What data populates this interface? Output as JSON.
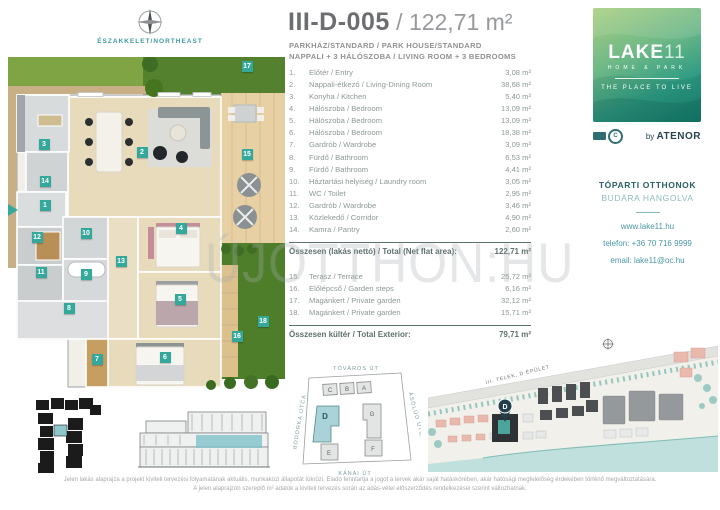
{
  "header": {
    "code": "III-D-005",
    "separator": " / ",
    "area": "122,71 m²",
    "subtitle1": "PARKHÁZ/STANDARD / PARK HOUSE/STANDARD",
    "subtitle2": "NAPPALI + 3 HÁLÓSZOBA  / LIVING ROOM + 3 BEDROOMS"
  },
  "compass": {
    "label": "ÉSZAKKELET/NORTHEAST"
  },
  "rooms": [
    {
      "no": "1.",
      "name": "Előtér / Entry",
      "area": "3,08 m²"
    },
    {
      "no": "2.",
      "name": "Nappali-étkező / Living-Dining Room",
      "area": "38,68 m²"
    },
    {
      "no": "3.",
      "name": "Konyha / Kitchen",
      "area": "5,40 m²"
    },
    {
      "no": "4.",
      "name": "Hálószoba / Bedroom",
      "area": "13,09 m²"
    },
    {
      "no": "5.",
      "name": "Hálószoba / Bedroom",
      "area": "13,09 m²"
    },
    {
      "no": "6.",
      "name": "Hálószoba / Bedroom",
      "area": "18,38 m²"
    },
    {
      "no": "7.",
      "name": "Gardrób / Wardrobe",
      "area": "3,09 m²"
    },
    {
      "no": "8.",
      "name": "Fürdő / Bathroom",
      "area": "6,53 m²"
    },
    {
      "no": "9.",
      "name": "Fürdő / Bathroom",
      "area": "4,41 m²"
    },
    {
      "no": "10.",
      "name": "Háztartási helyiség / Laundry room",
      "area": "3,05 m²"
    },
    {
      "no": "11.",
      "name": "WC / Toilet",
      "area": "2,95 m²"
    },
    {
      "no": "12.",
      "name": "Gardrób / Wardrobe",
      "area": "3,46 m²"
    },
    {
      "no": "13.",
      "name": "Közlekedő / Corridor",
      "area": "4,90 m²"
    },
    {
      "no": "14.",
      "name": "Kamra / Pantry",
      "area": "2,60 m²"
    }
  ],
  "net_total": {
    "label": "Összesen (lakás nettó) / Total (Net flat area):",
    "value": "122,71 m²"
  },
  "exterior_rooms": [
    {
      "no": "15.",
      "name": "Terasz / Terrace",
      "area": "25,72 m²"
    },
    {
      "no": "16.",
      "name": "Előlépcső / Garden steps",
      "area": "6,16 m²"
    },
    {
      "no": "17.",
      "name": "Magánkert / Private garden",
      "area": "32,12 m²"
    },
    {
      "no": "18.",
      "name": "Magánkert / Private garden",
      "area": "15,71 m²"
    }
  ],
  "exterior_total": {
    "label": "Összesen kültér / Total Exterior:",
    "value": "79,71 m²"
  },
  "plan_badges": [
    {
      "label": "1",
      "x": 37,
      "y": 148
    },
    {
      "label": "2",
      "x": 134,
      "y": 95
    },
    {
      "label": "3",
      "x": 36,
      "y": 87
    },
    {
      "label": "4",
      "x": 173,
      "y": 171
    },
    {
      "label": "5",
      "x": 172,
      "y": 242
    },
    {
      "label": "6",
      "x": 157,
      "y": 300
    },
    {
      "label": "7",
      "x": 89,
      "y": 302
    },
    {
      "label": "8",
      "x": 61,
      "y": 251
    },
    {
      "label": "9",
      "x": 78,
      "y": 217
    },
    {
      "label": "10",
      "x": 78,
      "y": 176
    },
    {
      "label": "11",
      "x": 33,
      "y": 215
    },
    {
      "label": "12",
      "x": 29,
      "y": 180
    },
    {
      "label": "13",
      "x": 113,
      "y": 204
    },
    {
      "label": "14",
      "x": 37,
      "y": 124
    },
    {
      "label": "15",
      "x": 239,
      "y": 97
    },
    {
      "label": "16",
      "x": 229,
      "y": 279
    },
    {
      "label": "17",
      "x": 239,
      "y": 9
    },
    {
      "label": "18",
      "x": 255,
      "y": 264
    }
  ],
  "watermark": "ÚJOTTHON:HU",
  "branding": {
    "logo_main": "LAKE",
    "logo_number": "11",
    "logo_sub": "HOME & PARK",
    "logo_tagline": "THE PLACE TO LIVE",
    "byline_by": "by ",
    "byline_brand": "ATENOR",
    "cert_letter": "C"
  },
  "contact": {
    "headline1": "TÓPARTI OTTHONOK",
    "headline2": "BUDÁRA HANGOLVA",
    "website": "www.lake11.hu",
    "phone": "telefon: +36 70 716 9999",
    "email": "email: lake11@oc.hu"
  },
  "site_map": {
    "street_top": "TÓVÁROS ÚT",
    "street_bottom": "KÁNAI ÚT",
    "street_left": "BODORKA UTCA",
    "street_right": "ÁSÓLÚD UTCA",
    "buildings": {
      "a": "A",
      "b": "B",
      "c": "C",
      "d": "D",
      "e": "E",
      "f": "F",
      "g": "G"
    }
  },
  "area_map": {
    "label": "III. TELEK, D ÉPÜLET",
    "marker": "D"
  },
  "disclaimer": {
    "line1": "Jelen lakás alaprajza a projekt kiviteli tervezési folyamatának aktuális, munkaközi állapotát tükrözi. Eladó fenntartja a jogot a tervek akár saját hatáskörében, akár hatósági megfelelőség érdekében történő megváltoztatására.",
    "line2": "A jelen alaprajzon szereplő m² adatok a kiviteli tervezés során az adás-vétel előszerződés rendelkezései szerint változhatnak."
  },
  "colors": {
    "accent": "#35a89c",
    "brand_dark": "#1d4e54",
    "link": "#4b97a4"
  }
}
